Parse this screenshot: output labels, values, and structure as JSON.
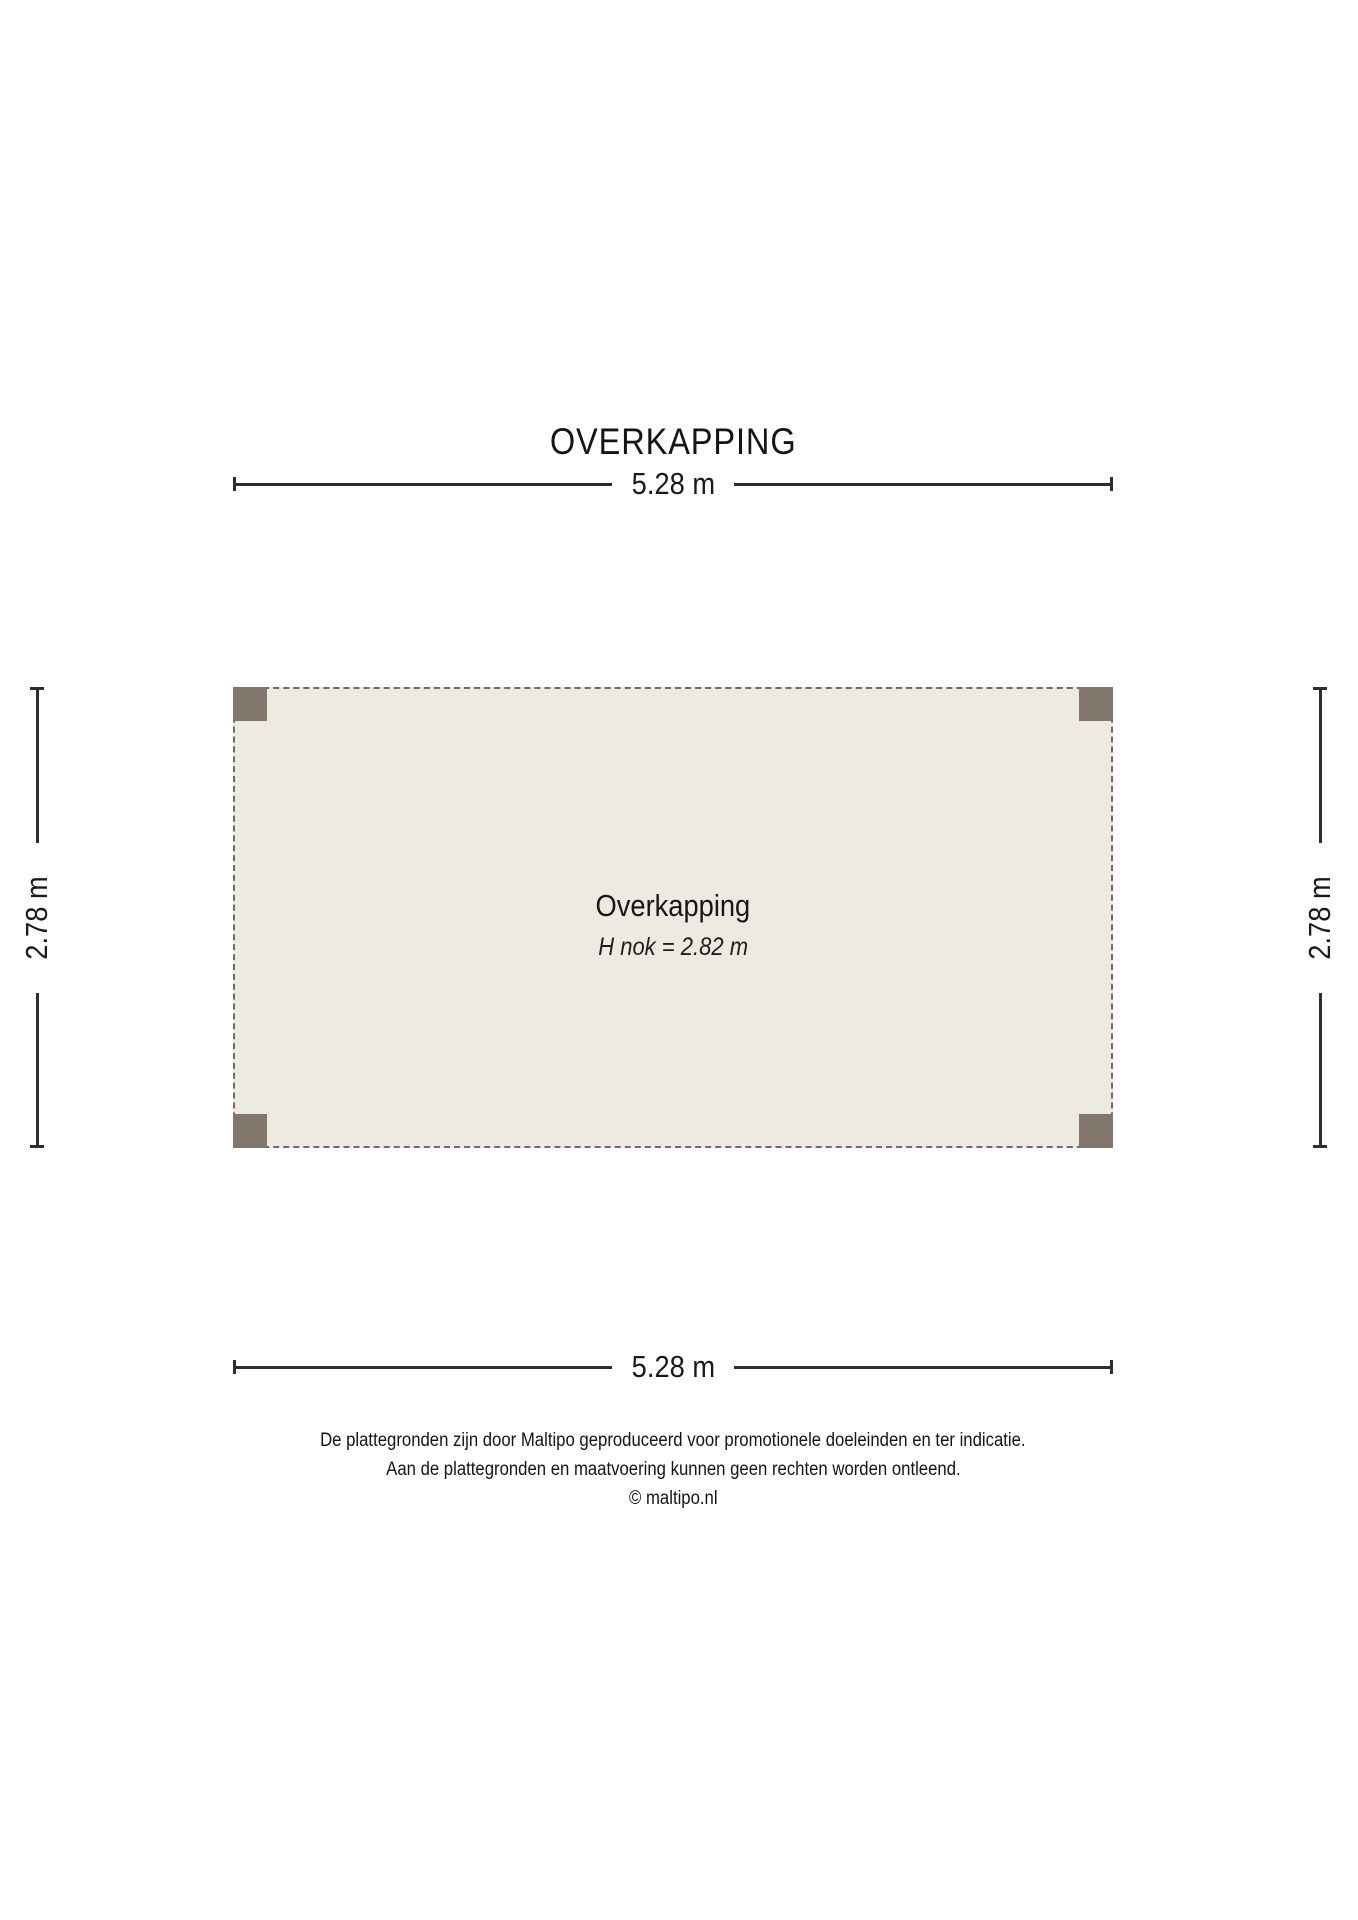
{
  "title": "OVERKAPPING",
  "plan": {
    "room_label": "Overkapping",
    "ridge_label": "H nok = 2.82 m",
    "fill_color": "#edeae2",
    "post_color": "#80766b",
    "dashed_border_color": "#6f6b64"
  },
  "dimensions": {
    "top": "5.28 m",
    "bottom": "5.28 m",
    "left": "2.78 m",
    "right": "2.78 m",
    "line_color": "#2e2e2e"
  },
  "footer": {
    "line1": "De plattegronden zijn door Maltipo geproduceerd voor promotionele doeleinden en ter indicatie.",
    "line2": "Aan de plattegronden en maatvoering kunnen geen rechten worden ontleend.",
    "line3": "© maltipo.nl"
  }
}
